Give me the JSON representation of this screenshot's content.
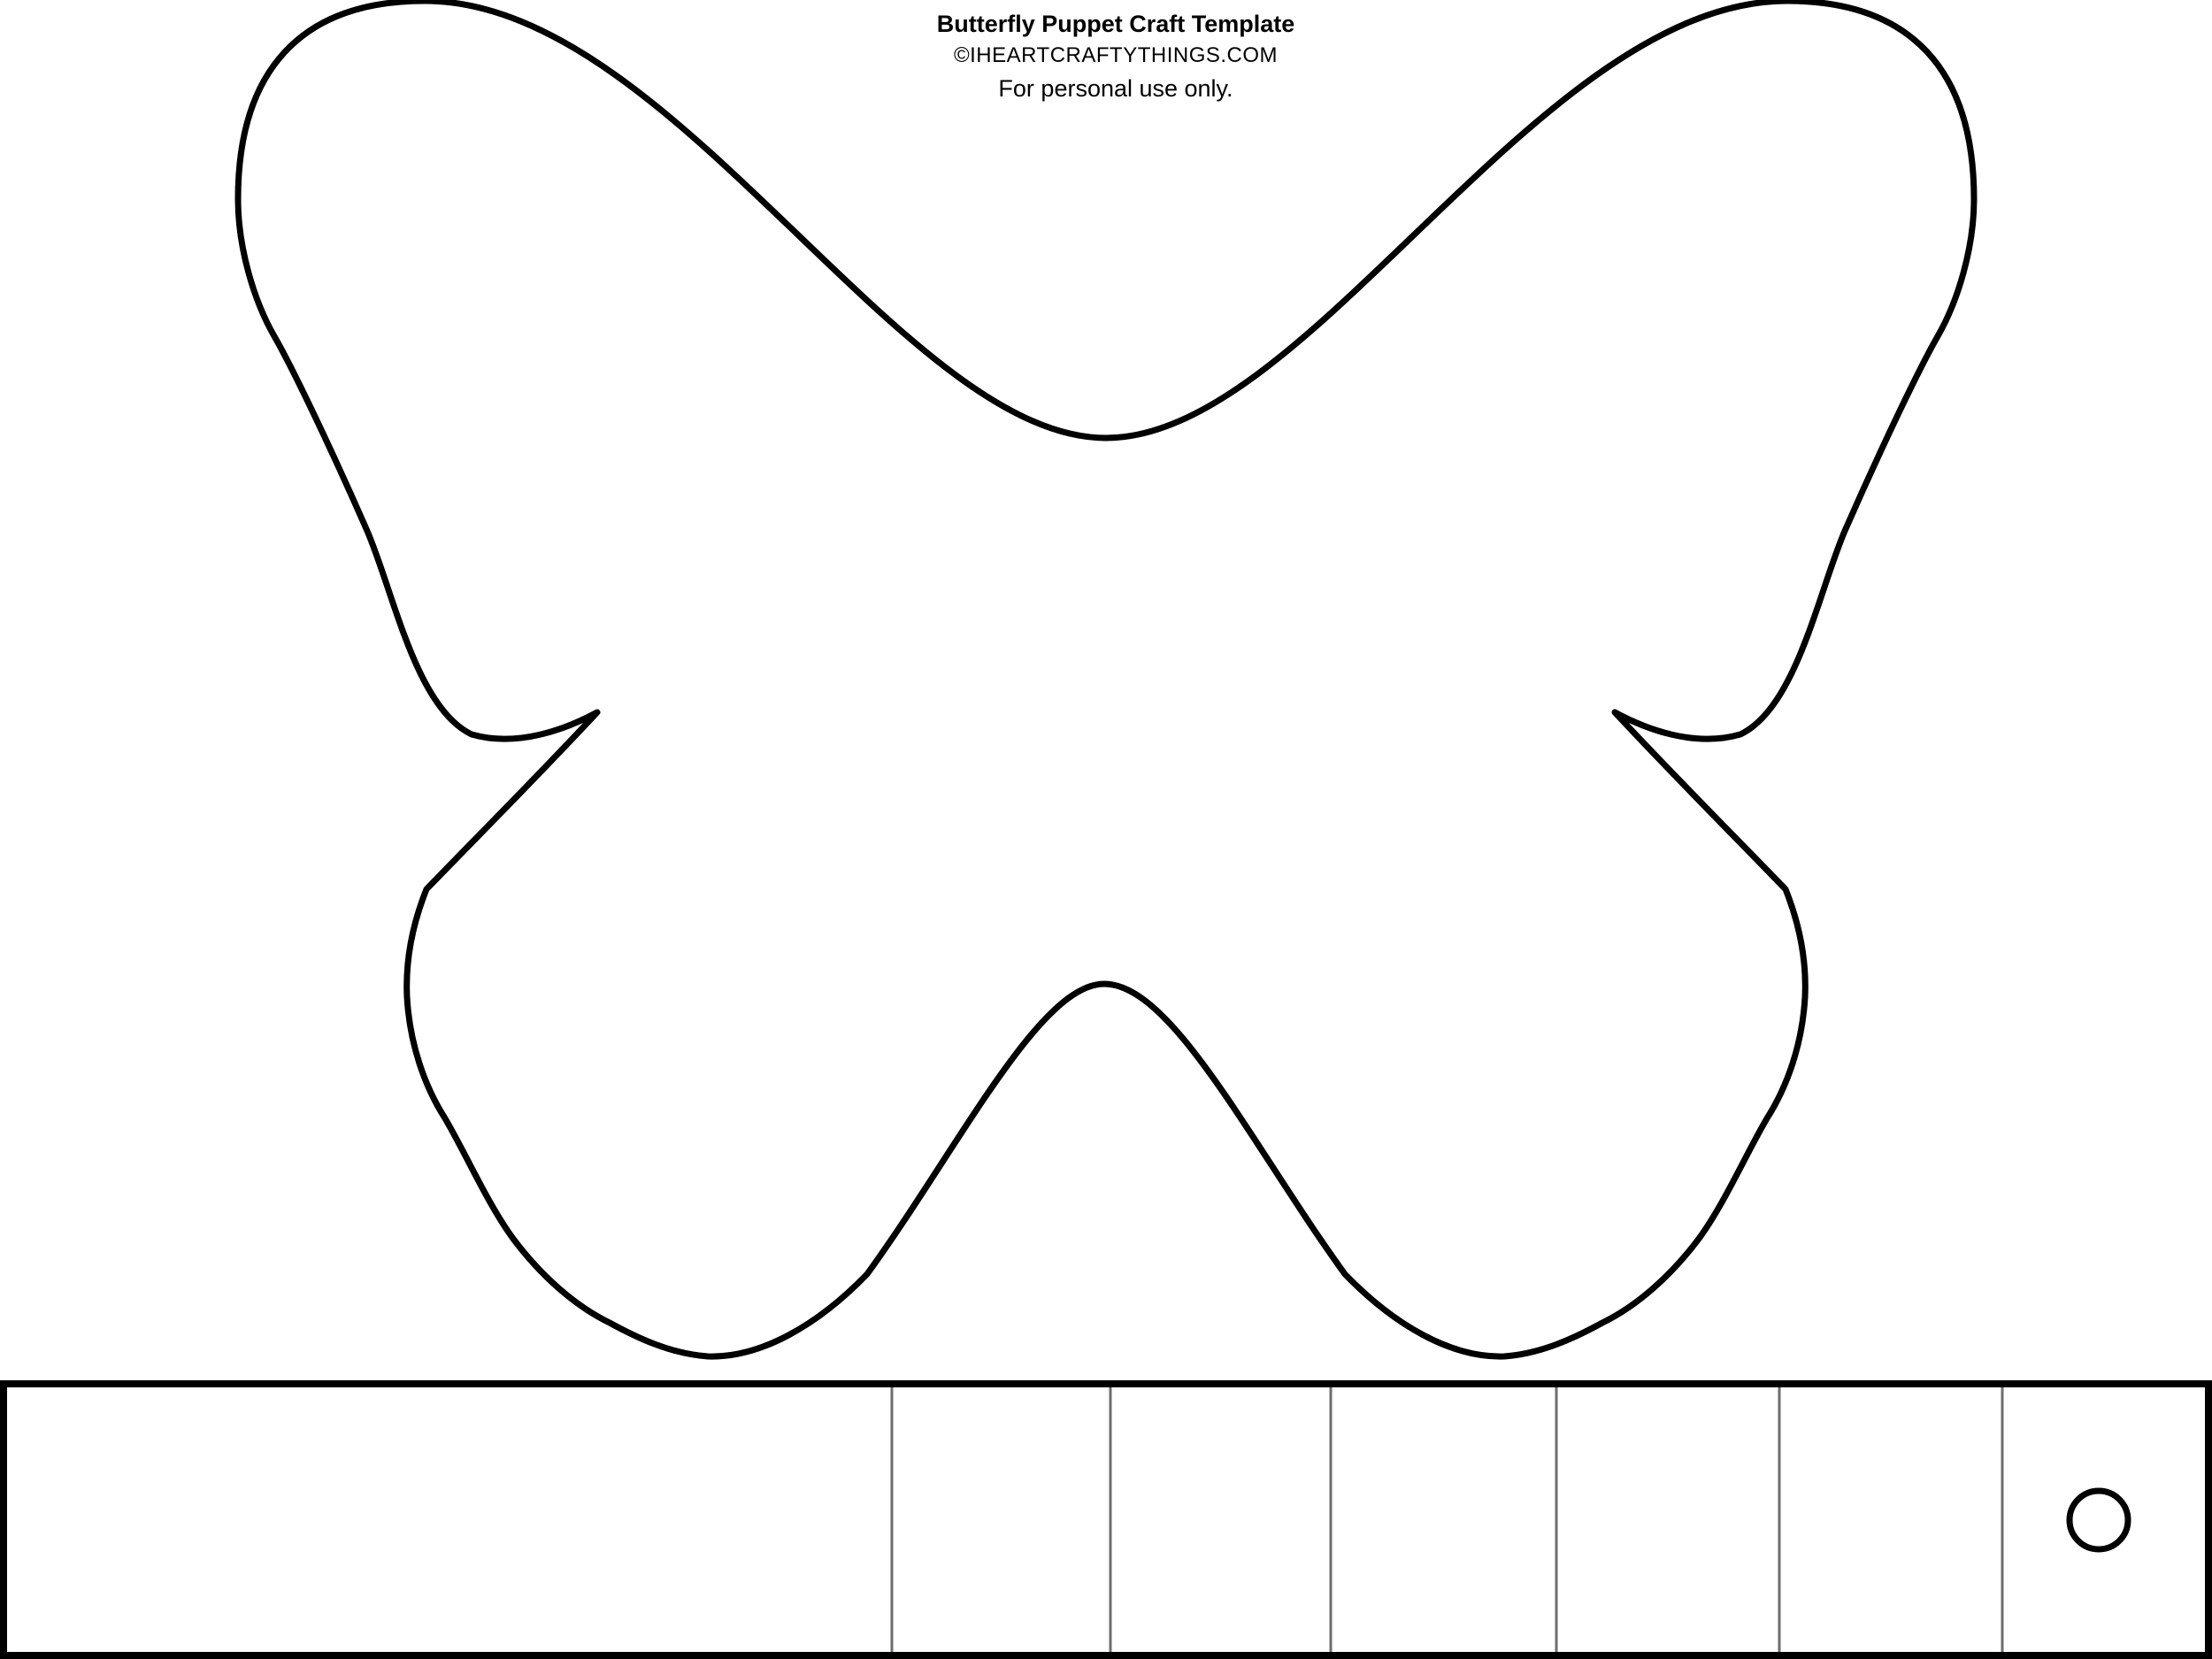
{
  "header": {
    "title": "Butterfly Puppet Craft Template",
    "copyright": "©IHEARTCRAFTYTHINGS.COM",
    "note": "For personal use only."
  },
  "colors": {
    "background": "#ffffff",
    "outline": "#000000",
    "fold_line": "#6e6e6e"
  },
  "strip": {
    "segments": 7,
    "punch_hole_shape": "circle"
  }
}
